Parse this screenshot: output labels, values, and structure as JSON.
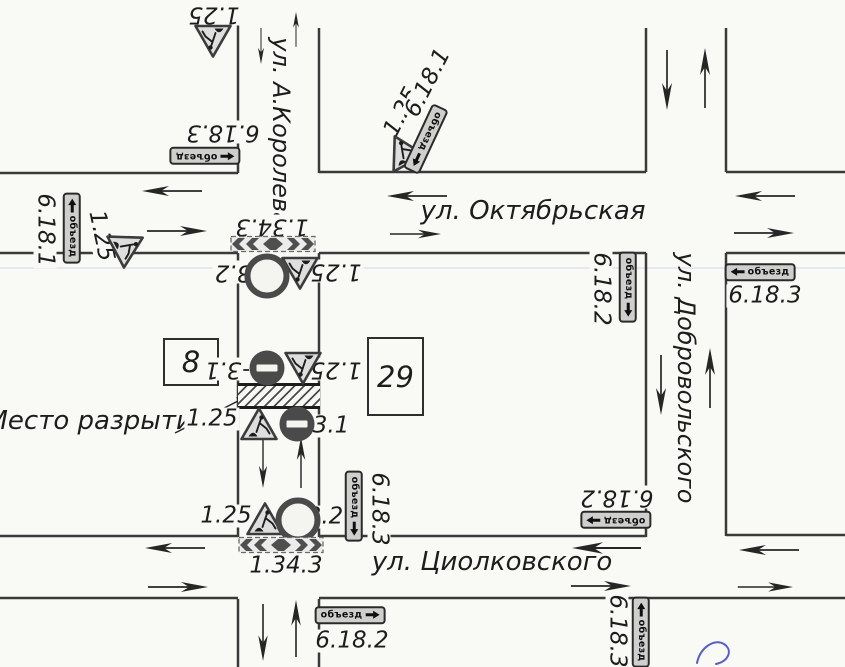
{
  "scheme": {
    "streets": {
      "koroleva": "ул. А.Королева",
      "oktyabrskaya": "ул. Октябрьская",
      "dobrovolskogo": "ул. Добровольского",
      "tsiolkovskogo": "ул. Циолковского"
    },
    "excavation_label": "Место разрытия",
    "buildings": {
      "left": "8",
      "right": "29"
    },
    "detour_text": "объезд",
    "codes": {
      "roadworks": "1.25",
      "no_entry": "3.1",
      "no_vehicles": "3.2",
      "chevron": "1.34.3",
      "detour_1": "6.18.1",
      "detour_2": "6.18.2",
      "detour_3": "6.18.3"
    },
    "colors": {
      "ink": "#3a3a3a",
      "paper": "#f9f9f6",
      "sign_fill": "#cfcfcd",
      "sign_dark": "#4a4a4a",
      "pen_mark": "#5a5fc7"
    }
  }
}
